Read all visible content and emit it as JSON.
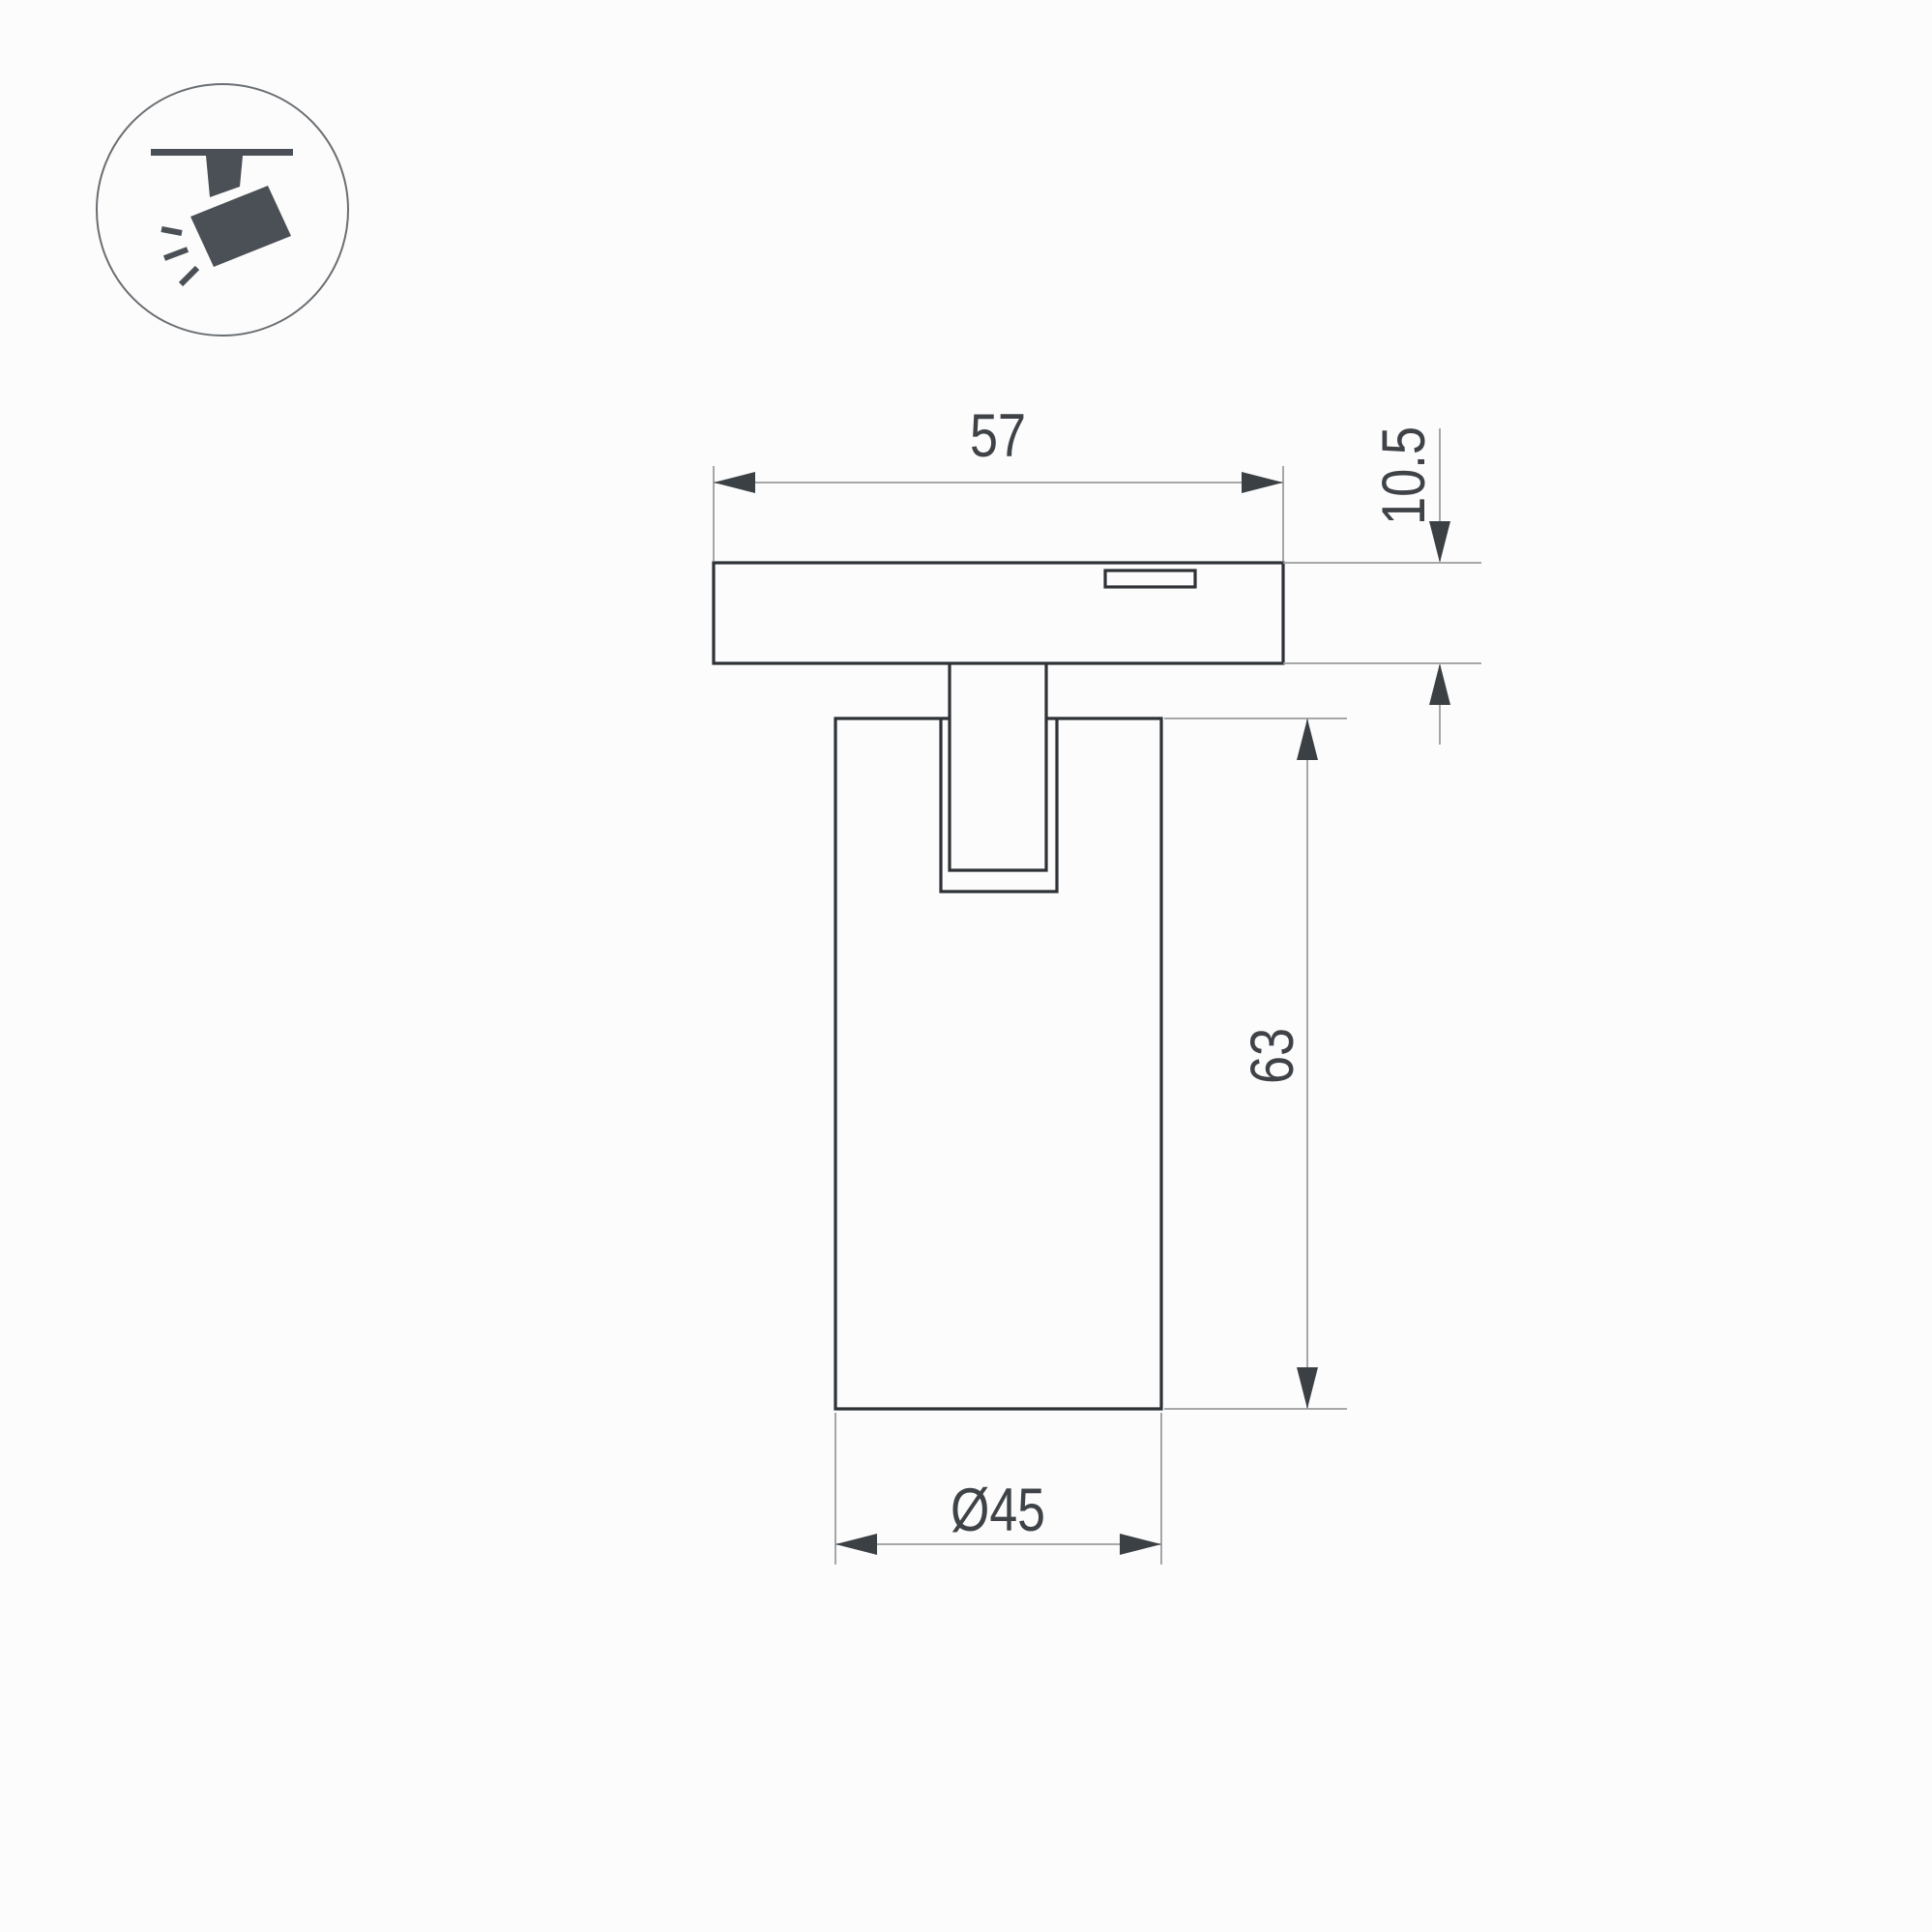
{
  "icon": {
    "name": "ceiling-track-spotlight-pictogram"
  },
  "drawing": {
    "type": "technical-dimension-drawing",
    "dimension_labels": {
      "adapter_width": "57",
      "adapter_height": "10.5",
      "body_height": "63",
      "body_diameter": "Ø45"
    },
    "colors": {
      "background": "#fcfcfc",
      "outline": "#2e3236",
      "dim_line": "#9b9c9e",
      "arrow": "#3b4045",
      "text": "#3f4347",
      "icon": "#4b5056",
      "icon_circle_border": "#6a6e72"
    }
  }
}
